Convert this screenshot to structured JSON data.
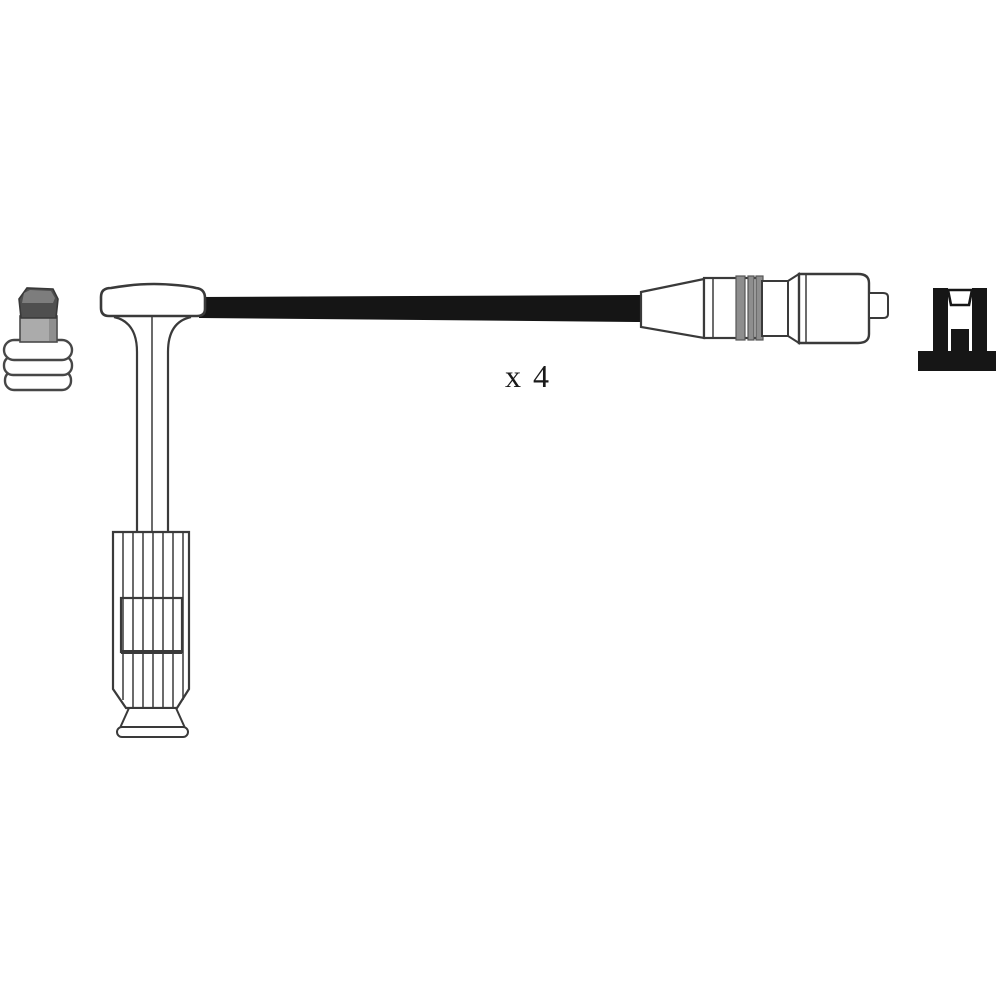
{
  "figure": {
    "kind": "product-line-drawing",
    "subject": "ignition-cable-kit",
    "quantity_label": "x 4",
    "parts": [
      {
        "name": "spark-plug-terminal-nut"
      },
      {
        "name": "spark-plug-boot"
      },
      {
        "name": "ignition-cable"
      },
      {
        "name": "coil-end-connector"
      },
      {
        "name": "mounting-clip"
      }
    ],
    "colors": {
      "background": "#ffffff",
      "outline": "#3a3a3a",
      "cable_black": "#151515",
      "clip_black": "#161616",
      "stripe_gray": "#8e8e8e",
      "terminal_dark_gray": "#4f4f4f",
      "terminal_mid_gray": "#ababab",
      "label_color": "#1a1a1a"
    }
  }
}
